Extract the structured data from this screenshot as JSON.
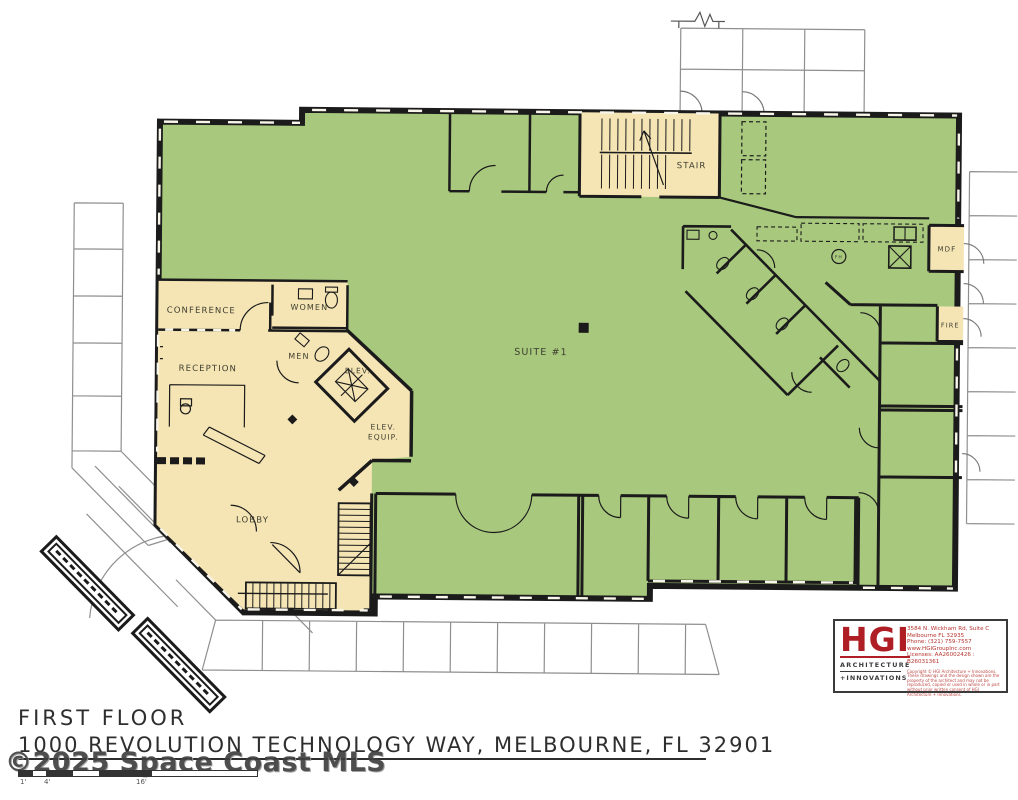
{
  "plan": {
    "title": "FIRST FLOOR",
    "address": "1000 REVOLUTION TECHNOLOGY WAY, MELBOURNE, FL 32901",
    "watermark": "©2025 Space Coast MLS",
    "rooms": {
      "suite": "SUITE #1",
      "stair": "STAIR",
      "conference": "CONFERENCE",
      "reception": "RECEPTION",
      "women": "WOMEN",
      "men": "MEN",
      "elev": "ELEV.",
      "elev_equip_line1": "ELEV.",
      "elev_equip_line2": "EQUIP.",
      "lobby": "LOBBY",
      "mdf": "MDF",
      "fire": "FIRE",
      "fh": "FH"
    },
    "scale_ticks": {
      "t1": "1'",
      "t2": "4'",
      "t3": "16'"
    },
    "colors": {
      "suite_green": "#a8c97d",
      "common_tan": "#f5e5b5",
      "wall_black": "#1b1b1b",
      "parking_gray": "#8f8f8f",
      "logo_red": "#ae1e24",
      "watermark_gray": "#3f3f3f"
    }
  },
  "logo": {
    "acronym": "HGI",
    "tagline1": "ARCHITECTURE",
    "tagline2": "+INNOVATIONS",
    "address1": "3584 N. Wickham Rd, Suite C",
    "address2": "Melbourne FL 32935",
    "address3": "Phone: (321) 759-7557",
    "address4": "www.HGIGroupInc.com",
    "address5": "Licenses: AA26002426 : B26031361",
    "fineprint": "Copyright © HGI Architecture + Innovations. These drawings and the design shown are the property of the architect and may not be reproduced, copied or used in whole or in part without prior written consent of HGI Architecture + Innovations."
  }
}
